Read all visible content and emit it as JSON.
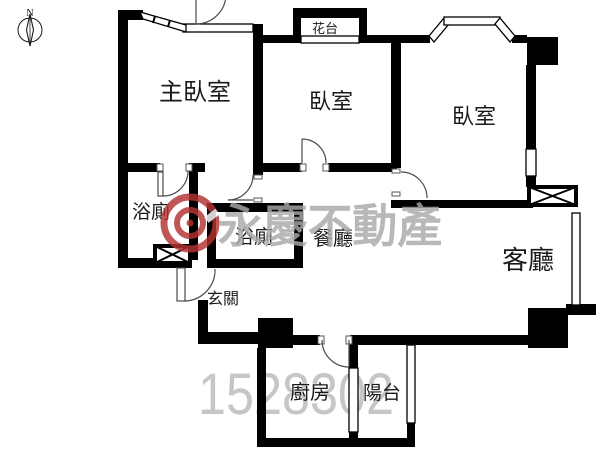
{
  "floorplan": {
    "compass": {
      "north_label": "N"
    },
    "rooms": [
      {
        "name": "master-bedroom",
        "label": "主臥室"
      },
      {
        "name": "bedroom-2",
        "label": "臥室"
      },
      {
        "name": "bedroom-3",
        "label": "臥室"
      },
      {
        "name": "bathroom-master",
        "label": "浴廁"
      },
      {
        "name": "bathroom-2",
        "label": "浴廁"
      },
      {
        "name": "dining-room",
        "label": "餐廳"
      },
      {
        "name": "living-room",
        "label": "客廳"
      },
      {
        "name": "entryway",
        "label": "玄關"
      },
      {
        "name": "kitchen",
        "label": "廚房"
      },
      {
        "name": "balcony",
        "label": "陽台"
      },
      {
        "name": "flower-stand",
        "label": "花台"
      }
    ],
    "watermark": {
      "brand_text": "永慶不動產",
      "listing_number": "1528302"
    },
    "colors": {
      "wall": "#000000",
      "watermark_text": "#a9a9a9",
      "watermark_number": "#c6c6c6",
      "logo_red": "#b43232"
    }
  }
}
